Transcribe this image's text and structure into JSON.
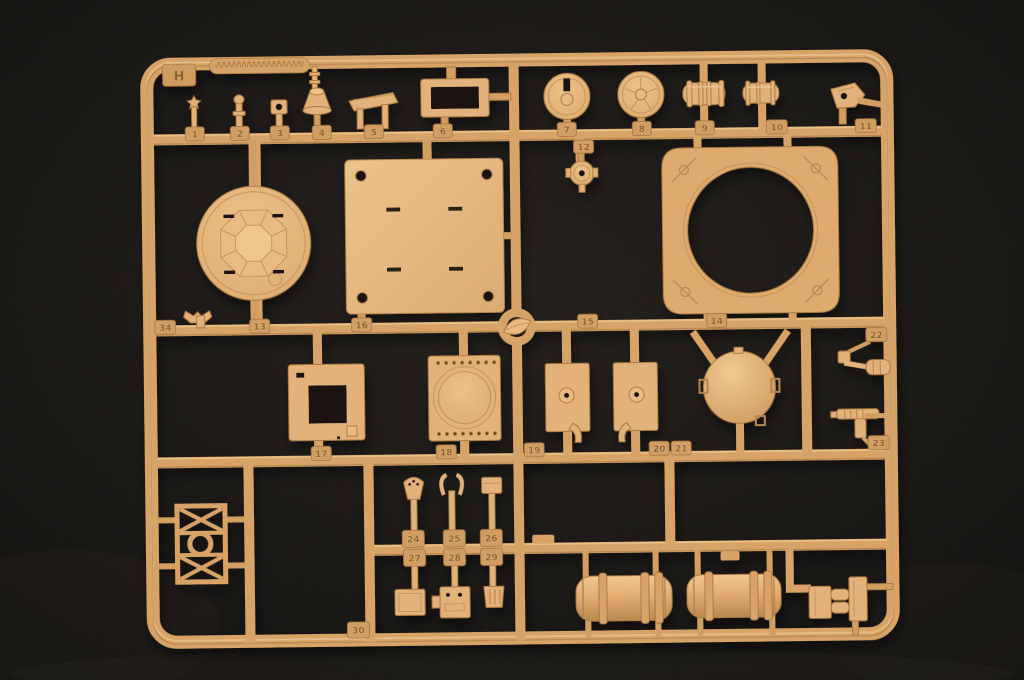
{
  "scene": {
    "type": "photograph",
    "subject": "tan plastic injection-molded model kit sprue with numbered parts on a black background",
    "plastic_color": "#d9a263",
    "background_color": "#131110"
  },
  "sprue": {
    "gate_letter": "H",
    "part_numbers": [
      "1",
      "2",
      "3",
      "4",
      "5",
      "6",
      "7",
      "8",
      "9",
      "10",
      "11",
      "12",
      "34",
      "13",
      "16",
      "15",
      "14",
      "17",
      "18",
      "19",
      "20",
      "21",
      "22",
      "23",
      "24",
      "25",
      "26",
      "27",
      "28",
      "29",
      "30"
    ]
  }
}
